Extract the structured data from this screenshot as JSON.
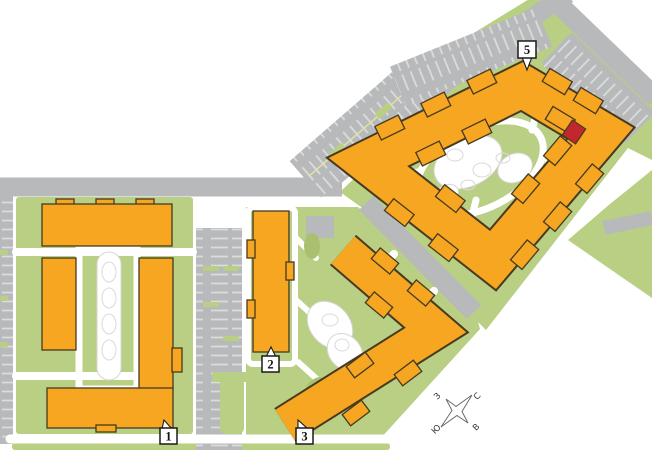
{
  "colors": {
    "background": "#FFFFFF",
    "building": "#F6A620",
    "building-outline": "#473A21",
    "landscape": "#B9CF83",
    "landscape-dark": "#A9C16F",
    "road": "#B7B9BB",
    "stripe": "#DBDCDC",
    "aisle-line": "#E6E2A2",
    "path": "#FFFFFF",
    "pond-outline": "#D6D6D2",
    "stone-outline": "#DADADA",
    "highlight": "#C1272D",
    "marker-bg": "#FFFFFF",
    "marker-border": "#1A1A1A",
    "marker-text": "#111111",
    "compass-stroke": "#6B6B6B",
    "compass-text": "#333333"
  },
  "site_map": {
    "markers": [
      {
        "id": "building-1",
        "label": "1"
      },
      {
        "id": "building-2",
        "label": "2"
      },
      {
        "id": "building-3",
        "label": "3"
      },
      {
        "id": "building-5",
        "label": "5"
      }
    ],
    "compass": {
      "north": "С",
      "east": "В",
      "south": "Ю",
      "west": "З"
    },
    "highlighted_unit": {
      "building": "5"
    }
  }
}
